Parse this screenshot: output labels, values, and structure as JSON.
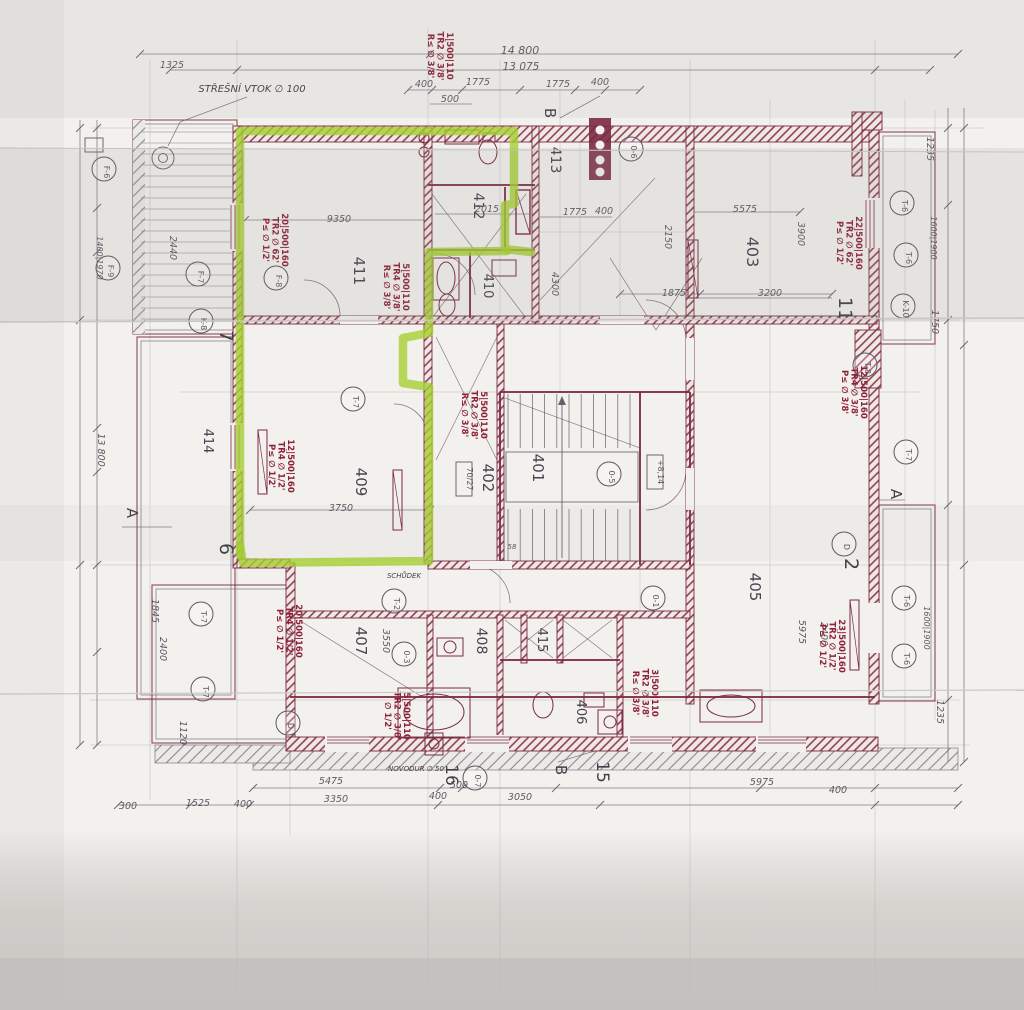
{
  "plan": {
    "colors": {
      "highlight": "#a5d030",
      "ink": "#7b2a42",
      "pencil": "#5b5862",
      "annotation_red": "#8e2138",
      "paper": "#f3f1ed"
    },
    "unit_highlight": {
      "number": "14"
    },
    "notes": {
      "roof_drain": "STŘEŠNÍ VTOK ∅ 100",
      "step": "SCHŮDEK",
      "pipe": "NOVODUR ∅ 50"
    },
    "rooms": {
      "r401": "401",
      "r402": "402",
      "r403": "403",
      "r405": "405",
      "r406": "406",
      "r407": "407",
      "r408": "408",
      "r409": "409",
      "r410": "410",
      "r411": "411",
      "r412": "412",
      "r413": "413",
      "r414": "414",
      "r415": "415"
    },
    "axes": {
      "a7": "7",
      "a6": "6",
      "a2": "2",
      "a11": "11",
      "a15": "15",
      "a16": "16",
      "aAL": "A",
      "aAR": "A",
      "aBT": "B",
      "aBB": "B"
    },
    "markers": {
      "c1": "F-6",
      "c2": "F-9",
      "c3": "F-7",
      "c4": "F-8",
      "c5": "K-8",
      "c6": "0-6",
      "c7": "0-5",
      "c8": "T-7",
      "c9": "T-7",
      "c10": "T-7",
      "c11": "D",
      "c12": "0-1",
      "c13": "T-2",
      "c14": "0-3",
      "c15": "0-7",
      "c16": "T-6",
      "c17": "T-6",
      "c18": "K-10",
      "c19": "T-8",
      "c20": "T-7",
      "c21": "T-6",
      "c22": "T-6",
      "c23": "D"
    },
    "elevation_tags": {
      "b1": "+8,14",
      "b2": "70/27"
    },
    "dimensions": {
      "d1": "14 800",
      "d2": "13 075",
      "d3": "400",
      "d4": "1775",
      "d5": "500",
      "d6": "1775",
      "d7": "400",
      "d8": "1325",
      "d9": "9350",
      "d10": "2015",
      "d11": "1775",
      "d12": "400",
      "d13": "5575",
      "d14": "1875",
      "d15": "3200",
      "d16": "2150",
      "d17": "3900",
      "d18": "4300",
      "d19": "3750",
      "d20": "3550",
      "d21": "2440",
      "d22": "1400|1970",
      "d23": "5475",
      "d24": "3350",
      "d25": "400",
      "d26": "500",
      "d27": "3050",
      "d28": "400",
      "d29": "5975",
      "d30": "1525",
      "d31": "400",
      "d32": "300",
      "d33": "13 800",
      "d34": "2400",
      "d35": "1120",
      "d36": "1845",
      "d37": "1235",
      "d38": "1600|1900",
      "d39": "1750",
      "d40": "2400",
      "d41": "1600|1900",
      "d42": "1235",
      "d43": "5975",
      "d44": "58"
    },
    "rebar_annotations": {
      "n1": "20|500|160\nTŘ2 ∅ 62'\nP≤ ∅ 1/2'",
      "n2": "5|500|110\nTŘ4 ∅ 3/8'\nR≤ ∅ 3/8'",
      "n3": "5|500|110\nTŘ2 ∅ 3/8'\nR≤ ∅ 3/8'",
      "n4": "22|500|160\nTŘ2 ∅ 62'\nP≤ ∅ 1/2'",
      "n5": "12|500|160\nTŘ4 ∅ 3/8'\nP≤ ∅ 3/8'",
      "n6": "20|500|160\nTŘ4 ∅ 1/2'\nP≤ ∅ 1/2'",
      "n7": "5|500|110\nTŘ2 ∅ 3/8'\n∅ 1/2'",
      "n8": "3|500|110\nTŘ2 ∅ 3/8'\nR≤ ∅ 3/8'",
      "n9": "23|500|160\nTŘ2 ∅ 1/2'\nP≤ ∅ 1/2'",
      "n10": "1|500|110\nTŘ2 ∅ 3/8'\nR≤ ∅ 3/8'",
      "n11": "12|500|160\nTŘ4 ∅ 1/2'\nP≤ ∅ 1/2'"
    }
  }
}
